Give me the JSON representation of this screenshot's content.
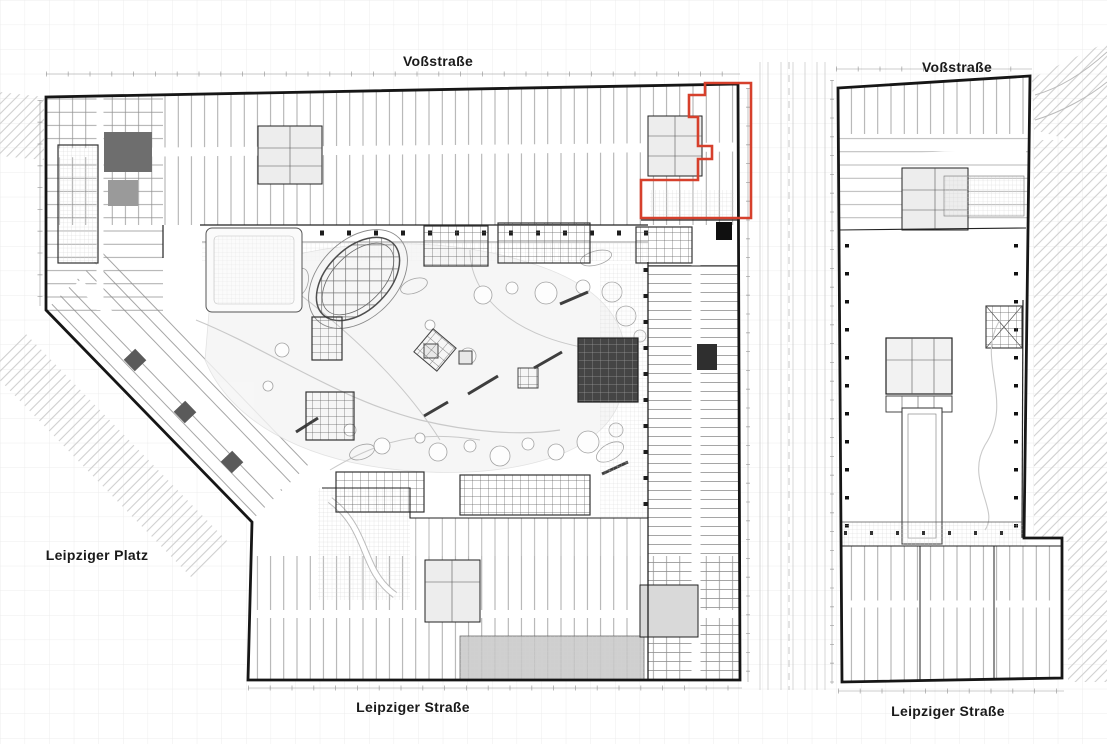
{
  "plan": {
    "street_labels": {
      "vossstrasse_main": "Voßstraße",
      "vossstrasse_right": "Voßstraße",
      "leipziger_platz": "Leipziger Platz",
      "leipziger_strasse_main": "Leipziger Straße",
      "leipziger_strasse_right": "Leipziger Straße"
    },
    "highlight": {
      "outline_color": "#d6402c"
    },
    "colors": {
      "walls": "#1a1a1a",
      "paper": "#ffffff",
      "page_grid": "#ececec",
      "hatching": "#cfcfcf"
    }
  }
}
